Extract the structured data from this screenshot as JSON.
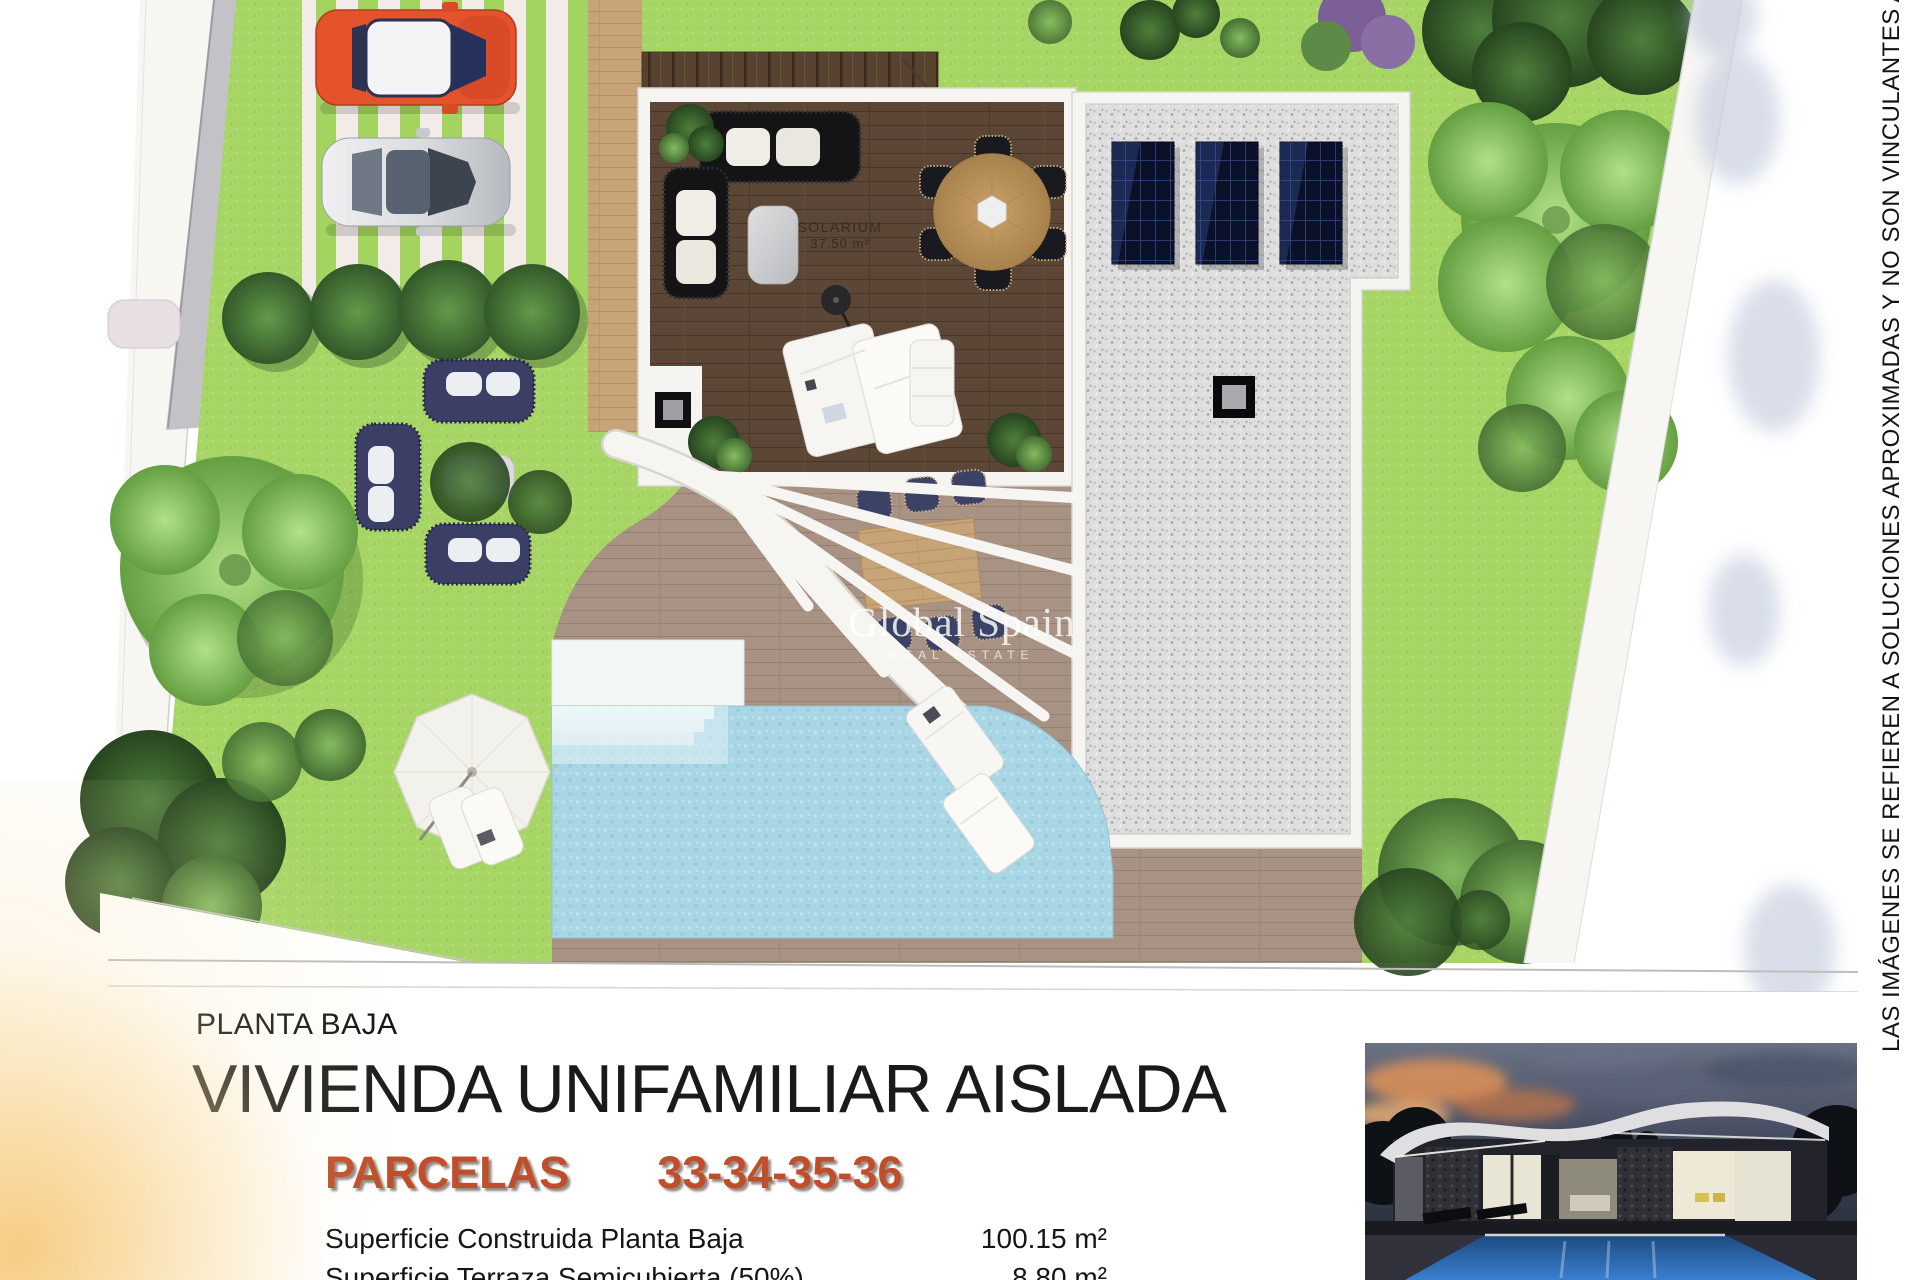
{
  "plan": {
    "solarium_label": "SOLARIUM",
    "solarium_area": "37.50 m²",
    "watermark_title": "Global Spain",
    "watermark_subtitle": "REAL ESTATE"
  },
  "disclaimer": "LAS IMÁGENES SE REFIEREN A SOLUCIONES APROXIMADAS Y NO SON VINCULANTES AL PROYECTO",
  "title_block": {
    "floor_label": "PLANTA BAJA",
    "title": "VIVIENDA UNIFAMILIAR AISLADA",
    "parcels_label": "PARCELAS",
    "parcels_numbers": "33-34-35-36",
    "specs": [
      {
        "label": "Superficie Construida Planta Baja",
        "value": "100.15 m²"
      },
      {
        "label": "Superficie Terraza Semicubierta (50%)",
        "value": "8.80 m²"
      }
    ]
  },
  "colors": {
    "accent": "#c14e2a",
    "grass": "#a7d566",
    "pool_water": "#aad7e6",
    "solarium_wood": "#5c4636",
    "terrace_wood": "#a79283",
    "gravel_roof": "#dedede",
    "solar_panel": "#0b1128",
    "car_orange": "#e5532d",
    "car_silver": "#d9dbdd"
  }
}
